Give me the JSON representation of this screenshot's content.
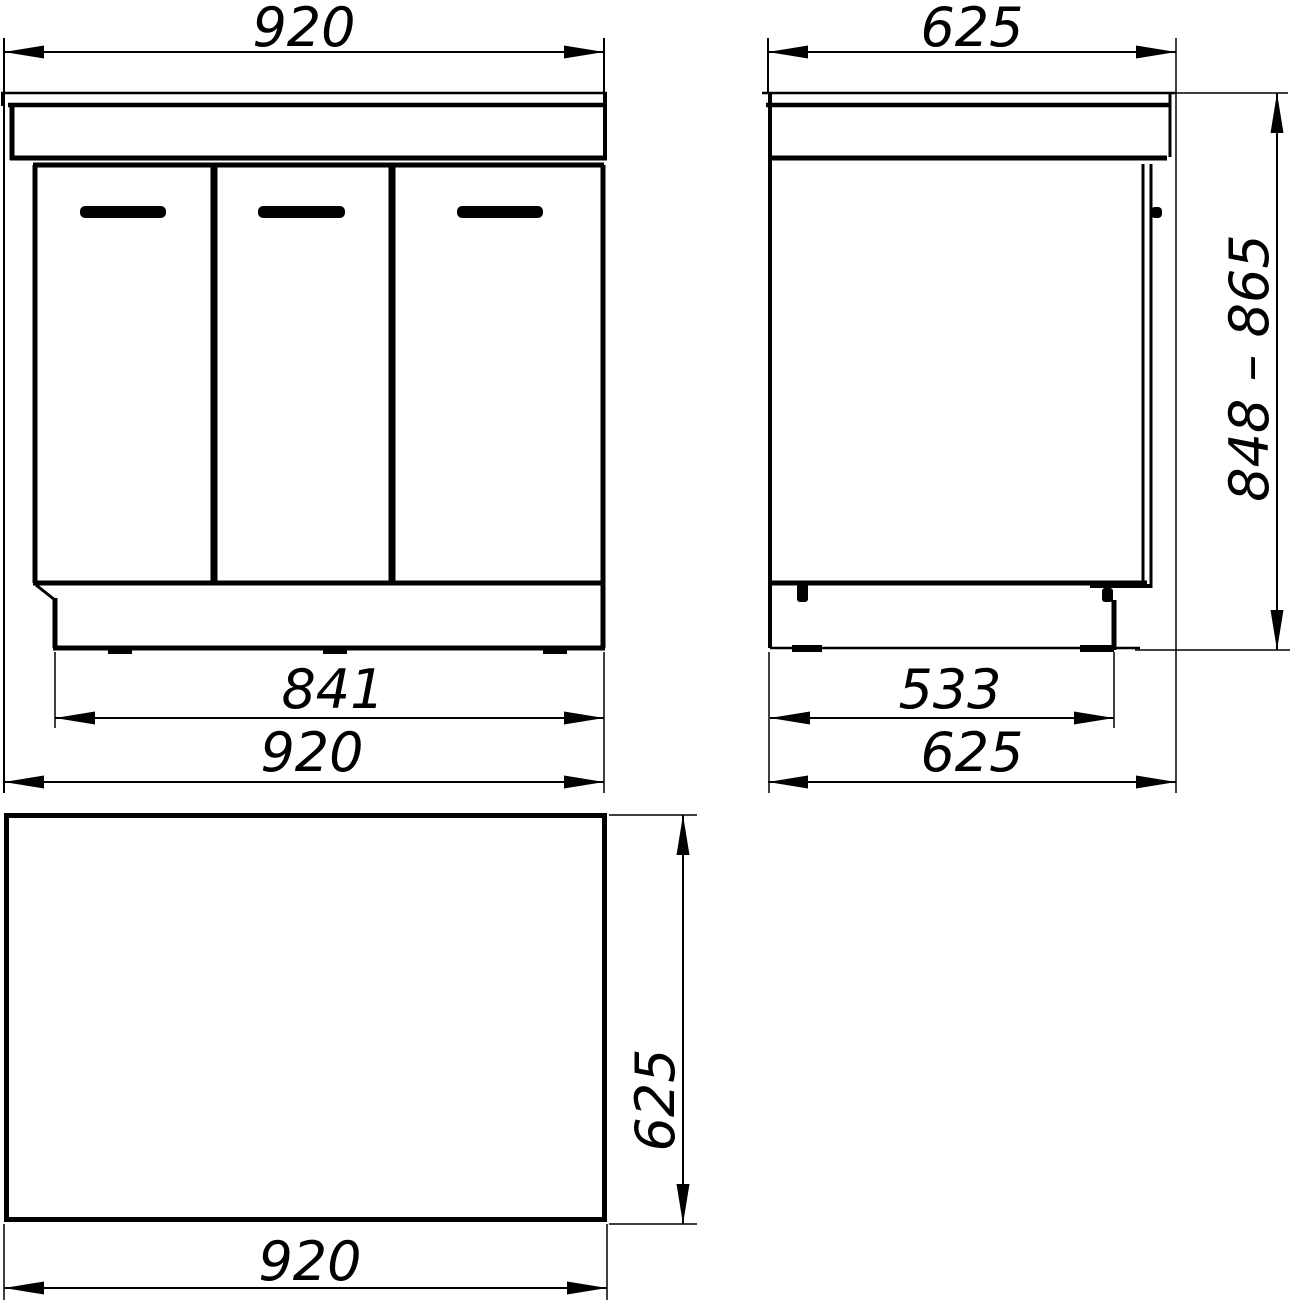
{
  "drawing": {
    "type": "cabinet-orthographic-dimension-drawing",
    "views": {
      "front": {
        "dim_width_top": "920",
        "dim_base_width": "841",
        "dim_width_bottom": "920"
      },
      "side": {
        "dim_depth_top": "625",
        "dim_base_depth": "533",
        "dim_depth_bottom": "625",
        "dim_height_range": "848 – 865"
      },
      "top": {
        "dim_depth": "625",
        "dim_width": "920"
      }
    }
  },
  "colors": {
    "line": "#000000",
    "background": "#ffffff"
  }
}
